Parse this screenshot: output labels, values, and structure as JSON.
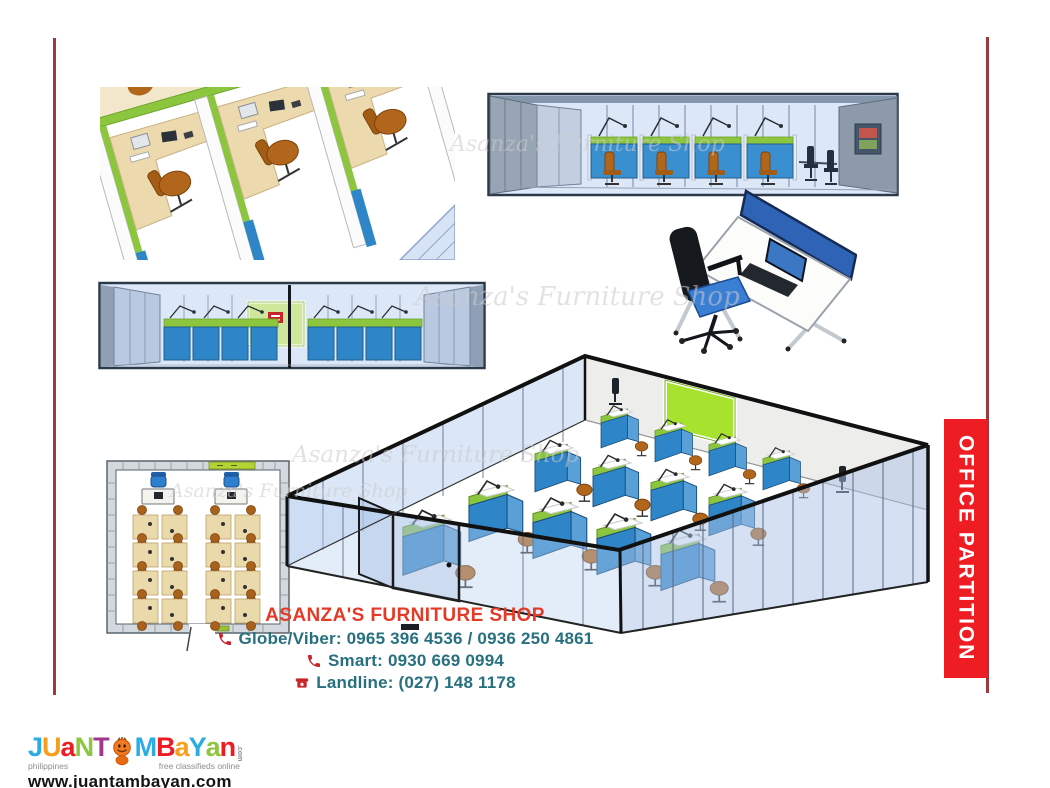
{
  "banner": {
    "label": "OFFICE PARTITION",
    "bg": "#ee1c23",
    "text_color": "#ffffff"
  },
  "accent": {
    "line_color": "#9a3a40"
  },
  "watermark": {
    "text": "Asanza's Furniture Shop"
  },
  "contact": {
    "shop_name": "ASANZA'S FURNITURE SHOP",
    "shop_name_color": "#e43a28",
    "phone_color": "#27707f",
    "icon_color": "#c8242b",
    "lines": [
      {
        "icon": "phone-handset-icon",
        "text": "Globe/Viber: 0965 396 4536 / 0936 250 4861"
      },
      {
        "icon": "phone-handset-icon",
        "text": "Smart: 0930 669 0994"
      },
      {
        "icon": "landline-phone-icon",
        "text": "Landline: (027) 148 1178"
      }
    ]
  },
  "footer_logo": {
    "letters": [
      {
        "ch": "J",
        "color": "#2bace2"
      },
      {
        "ch": "U",
        "color": "#f89c1c"
      },
      {
        "ch": "a",
        "color": "#ed1b24"
      },
      {
        "ch": "N",
        "color": "#8dc63f"
      },
      {
        "ch": "T",
        "color": "#a0378c"
      },
      {
        "ch": "M",
        "color": "#2bace2"
      },
      {
        "ch": "B",
        "color": "#ed1b24"
      },
      {
        "ch": "a",
        "color": "#f8a01c"
      },
      {
        "ch": "Y",
        "color": "#2bace2"
      },
      {
        "ch": "a",
        "color": "#8dc63f"
      },
      {
        "ch": "n",
        "color": "#ed1b24"
      }
    ],
    "dotcom": ".com",
    "tagline_left": "philippines",
    "tagline_right": "free classifieds online",
    "url": "www.juantambayan.com"
  }
}
